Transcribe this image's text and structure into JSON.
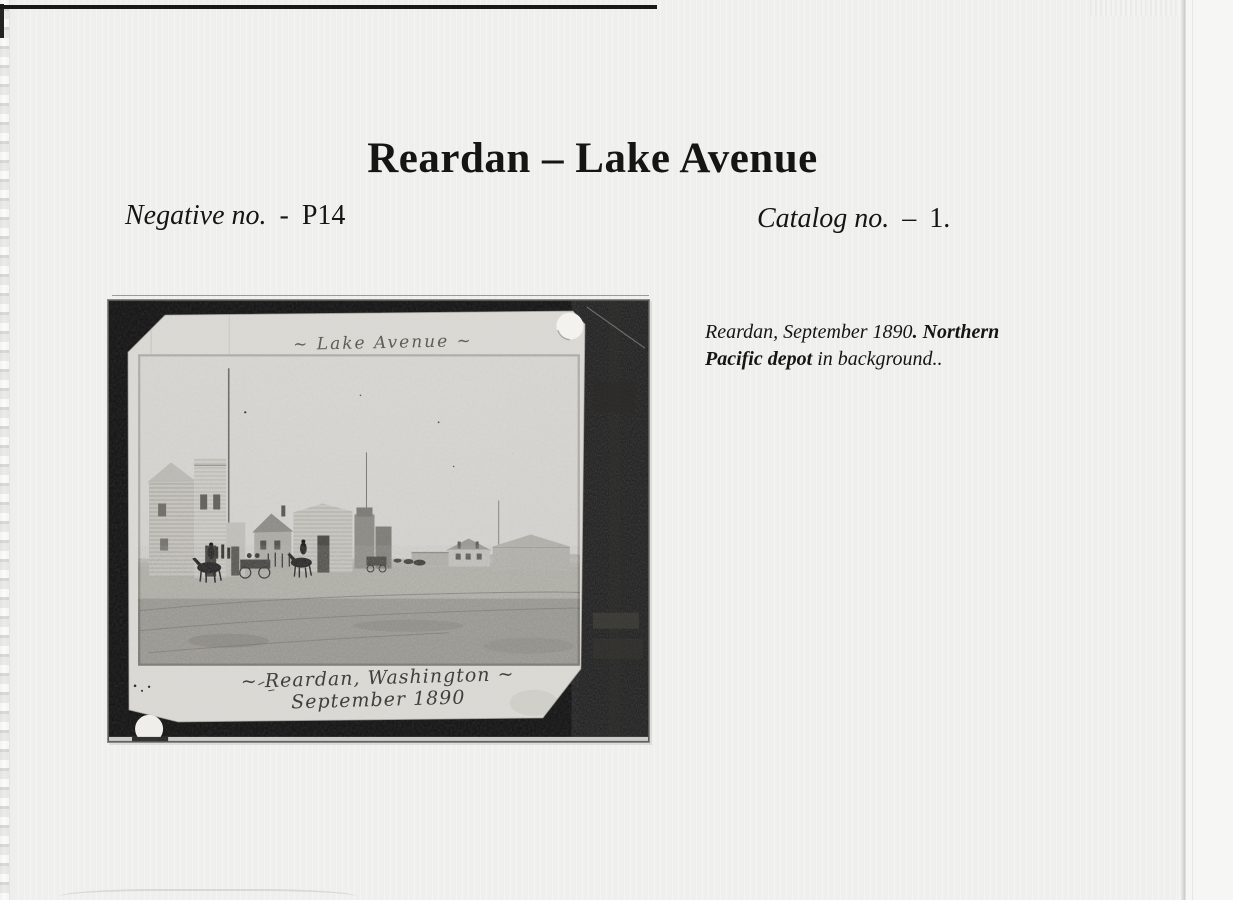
{
  "page": {
    "title": "Reardan – Lake Avenue",
    "negative": {
      "label": "Negative no.",
      "separator": "-",
      "value": "P14"
    },
    "catalog": {
      "label": "Catalog no.",
      "separator": "–",
      "value": "1."
    }
  },
  "photo": {
    "inscription_top": "~ Lake Avenue ~",
    "inscription_bottom_line1": "~ Reardan, Washington ~",
    "inscription_bottom_line2": "September 1890"
  },
  "caption": {
    "segments": [
      {
        "text": "Reardan, September 1890",
        "style": "italic"
      },
      {
        "text": ". ",
        "style": "bold-italic"
      },
      {
        "text": "Northern Pacific depot",
        "style": "bold-italic"
      },
      {
        "text": " in background..",
        "style": "italic"
      }
    ]
  },
  "colors": {
    "page-bg": "#f1f1ef",
    "ink": "#151515",
    "matte-black": "#121212",
    "photo-paper": "#dcdad5",
    "photo-sky": "#d5d4d0",
    "photo-ground": "#a3a19a",
    "handwriting-faint": "#5f5d58",
    "handwriting-dark": "#413f3b"
  }
}
